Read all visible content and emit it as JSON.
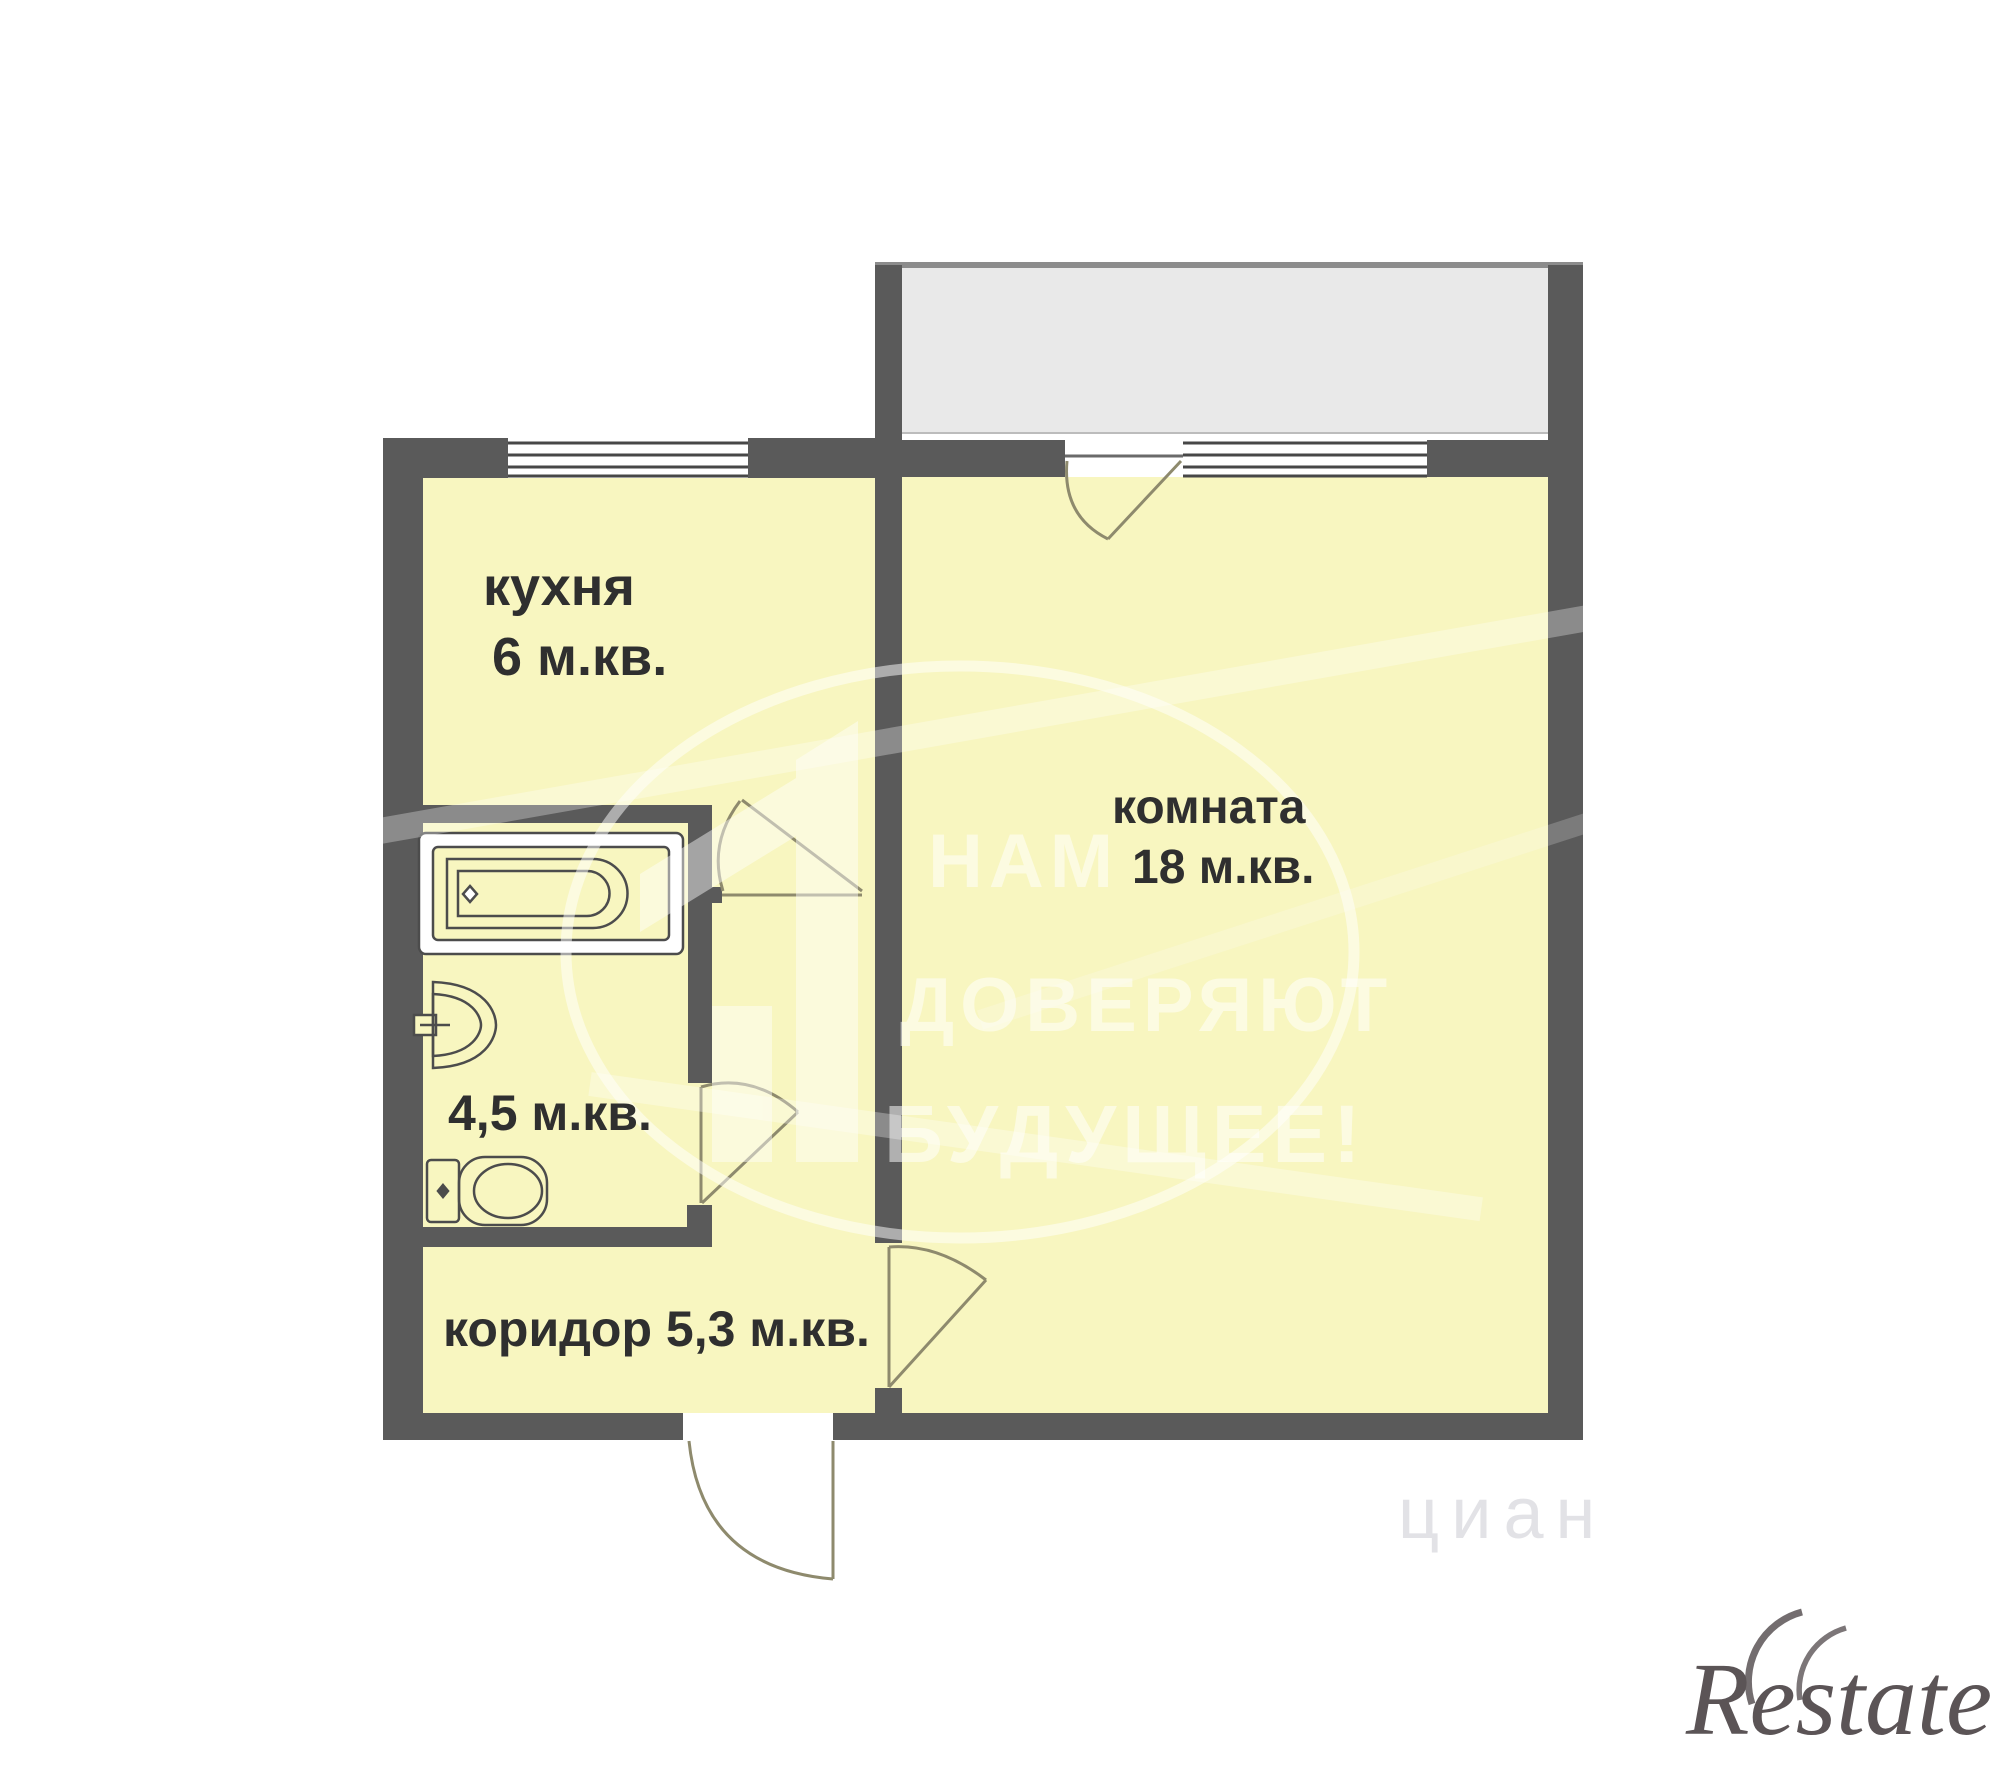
{
  "floor_plan": {
    "rooms": {
      "kitchen": {
        "name": "кухня",
        "area": "6  м.кв."
      },
      "room": {
        "name": "комната",
        "area": "18 м.кв."
      },
      "bathroom": {
        "area": "4,5 м.кв."
      },
      "corridor": {
        "label": "коридор 5,3 м.кв."
      }
    },
    "fixtures": [
      "bathtub-icon",
      "sink-icon",
      "toilet-icon"
    ],
    "colors": {
      "wall": "#5a5a5a",
      "floor": "#f8f6c0",
      "balcony": "#e9e9e9",
      "door_line": "#8e8a6d",
      "label_text": "#2f2f2f"
    }
  },
  "watermark": {
    "line1": "НАМ",
    "line2": "ДОВЕРЯЮТ",
    "line3": "БУДУЩЕЕ!",
    "icon": "building-icon",
    "faint_text": "циан"
  },
  "logo": {
    "brand": "Restate"
  }
}
